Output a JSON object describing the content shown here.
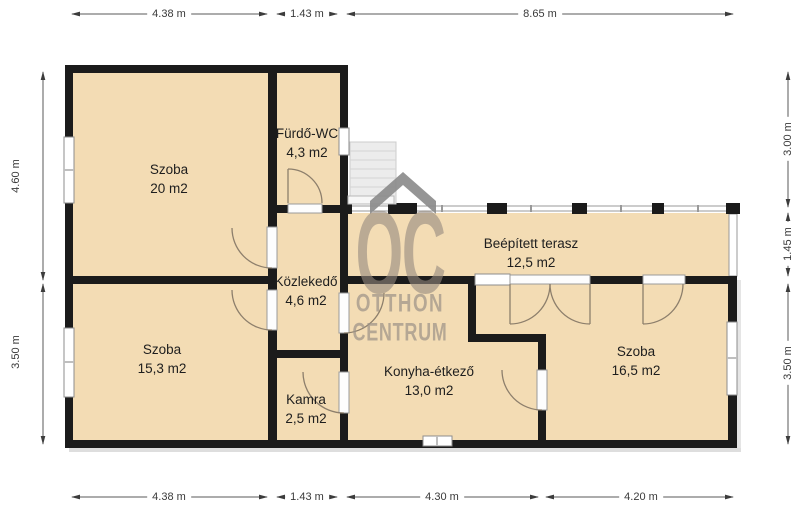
{
  "title": "Floor plan",
  "watermark": {
    "logo": "OC",
    "line1": "OTTHON",
    "line2": "CENTRUM"
  },
  "rooms": [
    {
      "id": "szoba-20",
      "name": "Szoba",
      "area": "20 m2"
    },
    {
      "id": "furdo-wc",
      "name": "Fürdő-WC",
      "area": "4,3 m2"
    },
    {
      "id": "kozlekedo",
      "name": "Közlekedő",
      "area": "4,6 m2"
    },
    {
      "id": "szoba-153",
      "name": "Szoba",
      "area": "15,3 m2"
    },
    {
      "id": "kamra",
      "name": "Kamra",
      "area": "2,5 m2"
    },
    {
      "id": "konyha",
      "name": "Konyha-étkező",
      "area": "13,0 m2"
    },
    {
      "id": "terasz",
      "name": "Beépített terasz",
      "area": "12,5 m2"
    },
    {
      "id": "szoba-165",
      "name": "Szoba",
      "area": "16,5 m2"
    }
  ],
  "dimensions": {
    "top": [
      "4.38 m",
      "1.43 m",
      "8.65 m"
    ],
    "bottom": [
      "4.38 m",
      "1.43 m",
      "4.30 m",
      "4.20 m"
    ],
    "left": [
      "4.60 m",
      "3.50 m"
    ],
    "right": [
      "3.00 m",
      "1.45 m",
      "3.50 m"
    ]
  },
  "colors": {
    "room_fill": "#f3dcb4",
    "wall": "#1b1b1b",
    "window_frame": "#8d8d8d",
    "door_arc": "#8d7f6c",
    "dimension": "#3c3c3c",
    "watermark": "#998f84"
  }
}
